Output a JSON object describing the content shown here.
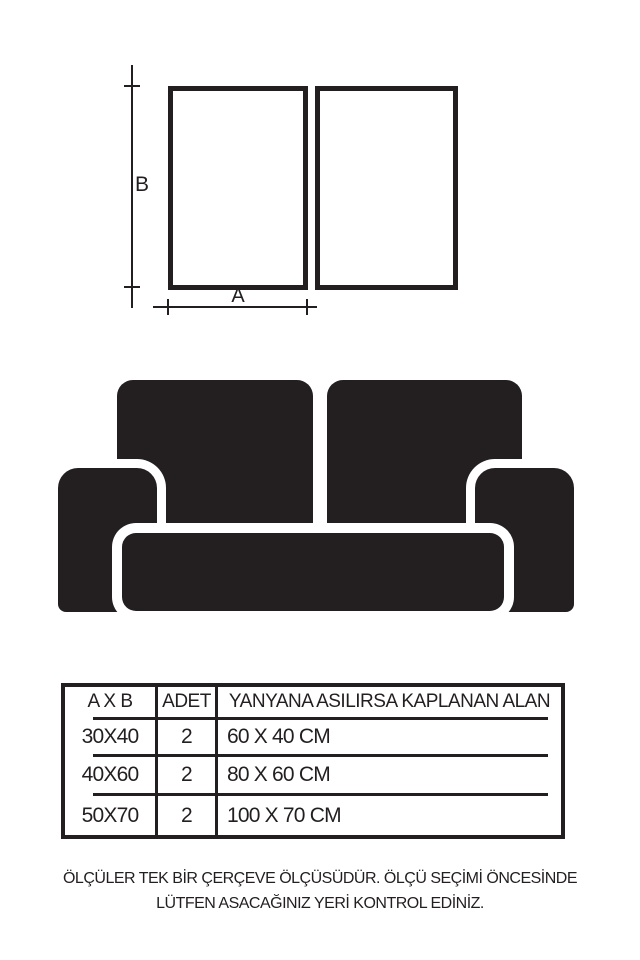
{
  "colors": {
    "ink": "#231f20",
    "background": "#ffffff"
  },
  "diagram": {
    "label_b": "B",
    "label_a": "A",
    "frames_count": 2
  },
  "sofa": {
    "parts": [
      "back-cushion-left",
      "back-cushion-right",
      "armrest-left",
      "armrest-right",
      "seat-cushion"
    ]
  },
  "table": {
    "headers": {
      "size": "A X B",
      "qty": "ADET",
      "area": "YANYANA ASILIRSA KAPLANAN ALAN"
    },
    "rows": [
      {
        "size": "30X40",
        "qty": "2",
        "area": "60 X 40 CM"
      },
      {
        "size": "40X60",
        "qty": "2",
        "area": "80 X 60 CM"
      },
      {
        "size": "50X70",
        "qty": "2",
        "area": "100 X 70 CM"
      }
    ]
  },
  "note": {
    "line1": "ÖLÇÜLER TEK BİR ÇERÇEVE ÖLÇÜSÜDÜR. ÖLÇÜ SEÇİMİ ÖNCESİNDE",
    "line2": "LÜTFEN ASACAĞINIZ YERİ KONTROL EDİNİZ."
  }
}
